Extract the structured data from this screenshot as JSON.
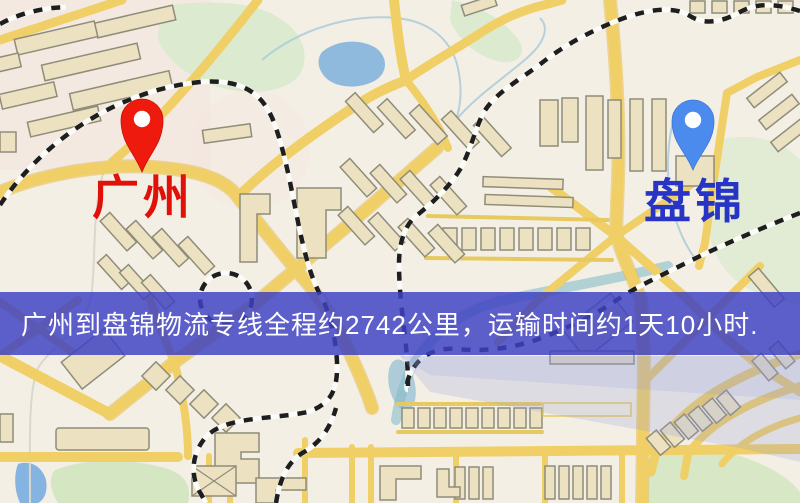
{
  "map": {
    "type": "road-map",
    "markers": [
      {
        "id": "guangzhou",
        "label": "广州",
        "pin_color": "#ee1a0e",
        "label_color": "#e01108",
        "pin_style": "red-teardrop"
      },
      {
        "id": "panjin",
        "label": "盘锦",
        "pin_color": "#4b8bee",
        "label_color": "#2734c4",
        "pin_style": "blue-teardrop"
      }
    ],
    "banner": {
      "text": "广州到盘锦物流专线全程约2742公里，运输时间约1天10小时.",
      "background": "#3e42c4",
      "text_color": "#ffffff"
    },
    "route": {
      "origin": "广州",
      "destination": "盘锦",
      "distance_km": "2742",
      "duration": "1天10小时"
    },
    "palette": {
      "background": "#f4efe5",
      "road": "#f0cf67",
      "building_fill": "#ece2c2",
      "building_stroke": "#8f8c7a",
      "park": "#dcead0",
      "water": "#8fbade",
      "railway": "#1e1e1e"
    }
  }
}
